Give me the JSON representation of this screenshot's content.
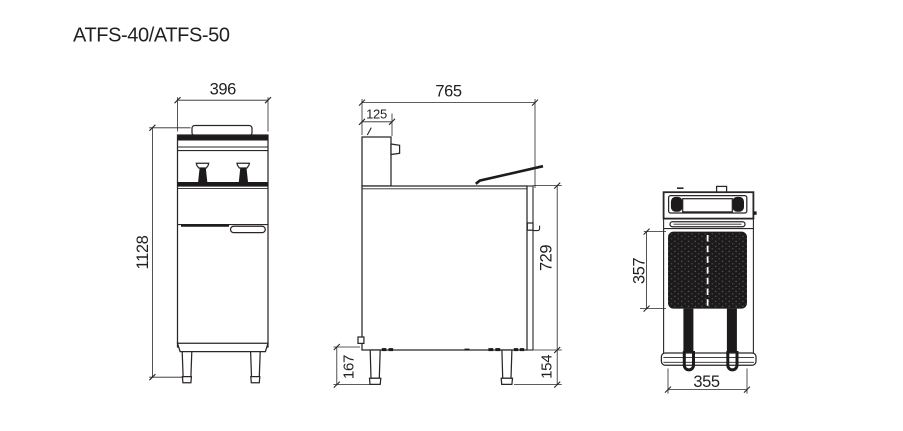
{
  "title": "ATFS-40/ATFS-50",
  "colors": {
    "line": "#2a2627",
    "ink": "#1c1a1b",
    "background": "#ffffff"
  },
  "views": {
    "front": {
      "name": "front elevation",
      "dim_width": "396",
      "dim_height": "1128"
    },
    "side": {
      "name": "side elevation",
      "dim_depth": "765",
      "dim_control_panel": "125",
      "dim_body_height": "729",
      "dim_front_leg": "167",
      "dim_rear_leg": "154"
    },
    "top": {
      "name": "plan view",
      "dim_tank_depth": "357",
      "dim_tank_width": "355"
    }
  }
}
